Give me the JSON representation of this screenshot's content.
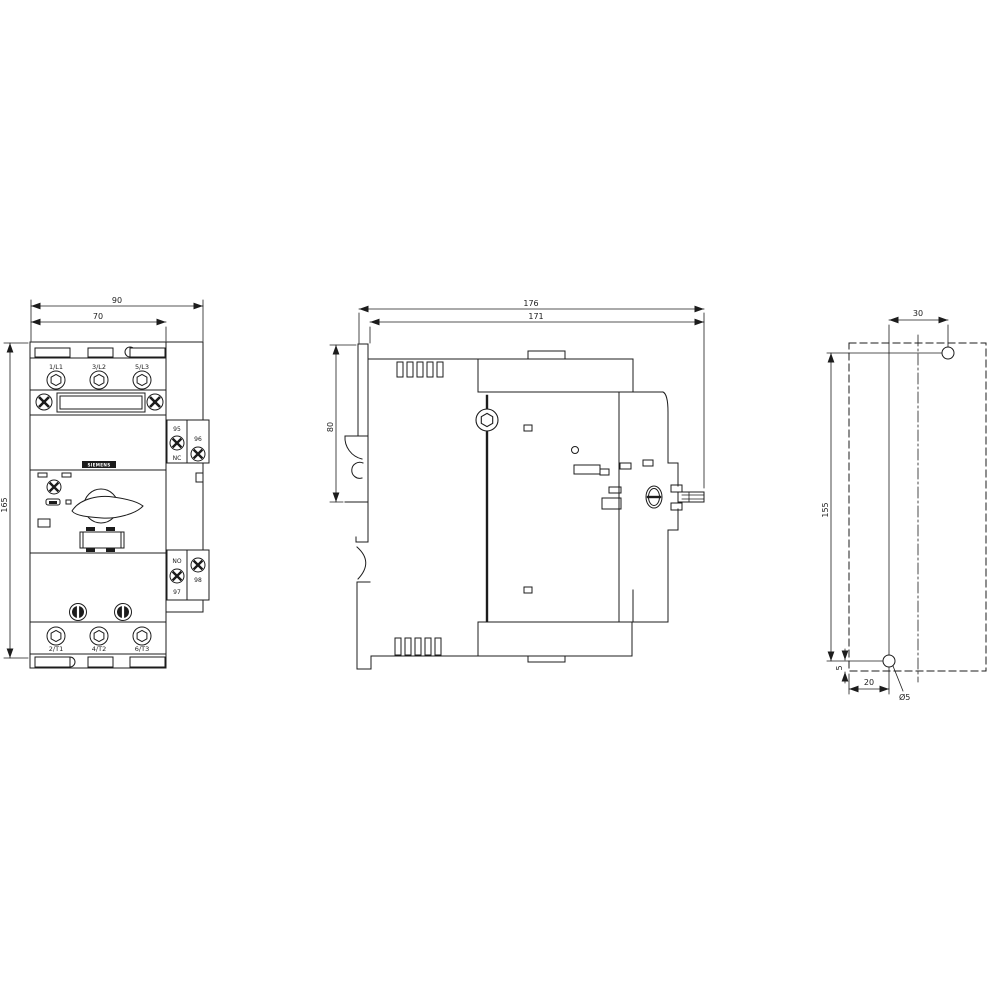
{
  "front_view": {
    "dim_overall_width": "90",
    "dim_body_width": "70",
    "dim_height": "165",
    "terminals_top": [
      "1/L1",
      "3/L2",
      "5/L3"
    ],
    "terminals_bottom": [
      "2/T1",
      "4/T2",
      "6/T3"
    ],
    "brand_plate": "SIEMENS",
    "aux_contacts": {
      "t95": "95",
      "t96": "96",
      "nc": "NC",
      "no": "NO",
      "t97": "97",
      "t98": "98"
    }
  },
  "side_view": {
    "dim_depth_overall": "176",
    "dim_depth_body": "171",
    "dim_upper_height": "80"
  },
  "drilling_plan": {
    "dim_hole_offset_x": "30",
    "dim_hole_spacing_y": "155",
    "dim_hole_edge_x": "20",
    "dim_hole_edge_y": "5",
    "hole_diameter": "Ø5"
  },
  "colors": {
    "line": "#1c1c1c",
    "background": "#ffffff"
  }
}
